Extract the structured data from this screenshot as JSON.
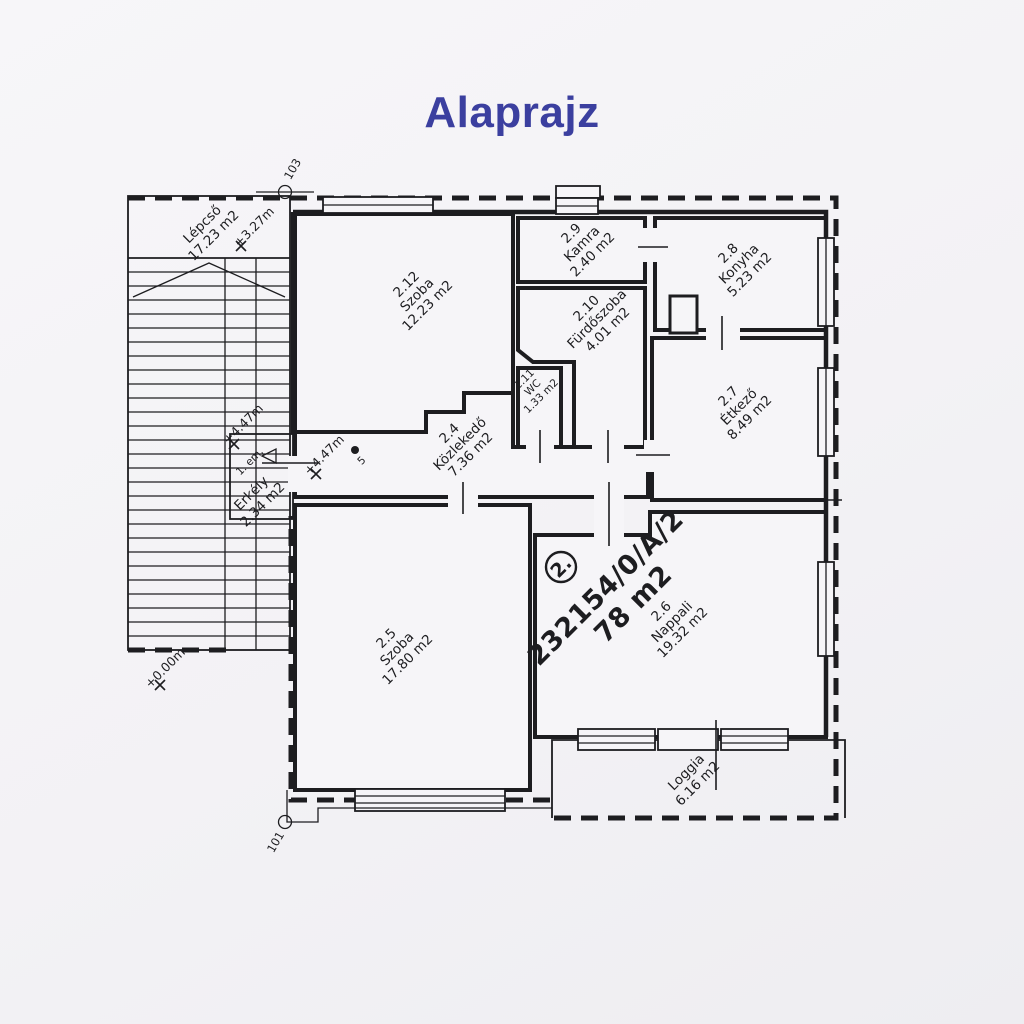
{
  "page": {
    "title": "Alaprajz"
  },
  "colors": {
    "title_blue": "#3b3f9f",
    "ink": "#1d1d20",
    "paper": "#f3f2f5"
  },
  "plan": {
    "unit_badge": {
      "number": "2.",
      "parcel": "232154/0/A/2",
      "area": "78 m2"
    },
    "markers": [
      {
        "label": "103"
      },
      {
        "label": "101"
      }
    ],
    "floor_note": "1. em.",
    "survey_point": "5",
    "elevations": [
      {
        "label": "+3.27m"
      },
      {
        "label": "+4.47m"
      },
      {
        "label": "+4.47m"
      },
      {
        "label": "+0.00m"
      }
    ],
    "rooms": [
      {
        "id": "2.12",
        "name": "Szoba",
        "area": "12.23 m2"
      },
      {
        "id": "2.9",
        "name": "Kamra",
        "area": "2.40 m2"
      },
      {
        "id": "2.8",
        "name": "Konyha",
        "area": "5.23 m2"
      },
      {
        "id": "2.10",
        "name": "Fürdőszoba",
        "area": "4.01 m2"
      },
      {
        "id": "2.11",
        "name": "WC",
        "area": "1.33 m2"
      },
      {
        "id": "2.7",
        "name": "Étkező",
        "area": "8.49 m2"
      },
      {
        "id": "2.4",
        "name": "Közlekedő",
        "area": "7.36 m2"
      },
      {
        "id": "2.5",
        "name": "Szoba",
        "area": "17.80 m2"
      },
      {
        "id": "2.6",
        "name": "Nappali",
        "area": "19.32 m2"
      },
      {
        "id": "",
        "name": "Erkély",
        "area": "2.34 m2"
      },
      {
        "id": "",
        "name": "Loggia",
        "area": "6.16 m2"
      },
      {
        "id": "",
        "name": "Lépcső",
        "area": "17.23 m2"
      }
    ]
  }
}
